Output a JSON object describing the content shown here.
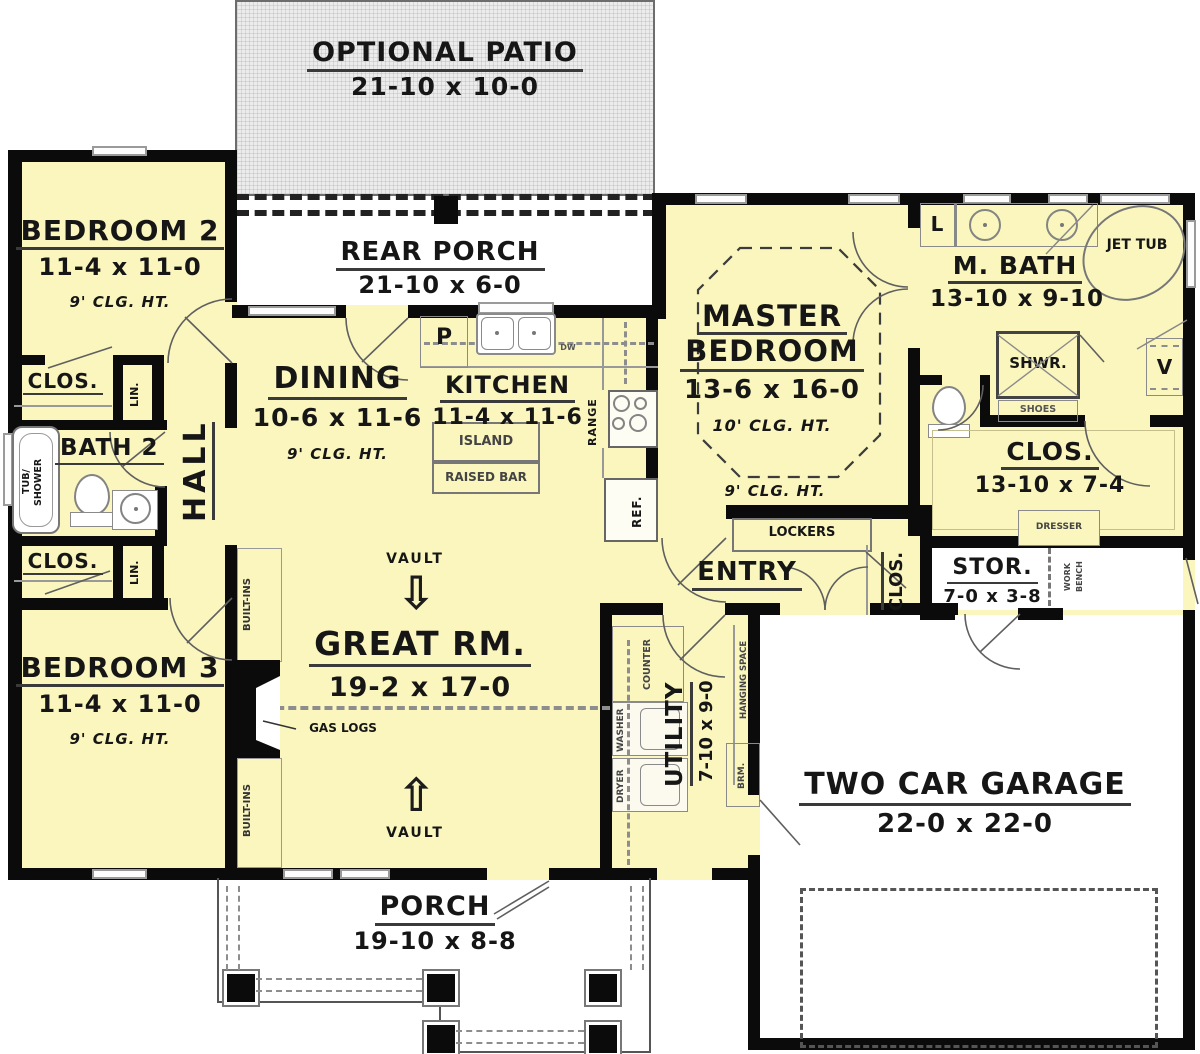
{
  "colors": {
    "floor": "#FAF6BE",
    "wall": "#0B0B0B",
    "patio_fill": "#ECECEC",
    "fixture_line": "#8A8A8A",
    "underline": "#3A3A3A"
  },
  "rooms": {
    "optional_patio": {
      "name": "OPTIONAL PATIO",
      "dims": "21-10 x 10-0"
    },
    "rear_porch": {
      "name": "REAR PORCH",
      "dims": "21-10 x 6-0"
    },
    "bedroom2": {
      "name": "BEDROOM 2",
      "dims": "11-4 x 11-0",
      "ceiling": "9' CLG. HT."
    },
    "bedroom3": {
      "name": "BEDROOM 3",
      "dims": "11-4 x 11-0",
      "ceiling": "9' CLG. HT."
    },
    "bath2": {
      "name": "BATH 2"
    },
    "hall": {
      "name": "HALL"
    },
    "dining": {
      "name": "DINING",
      "dims": "10-6 x 11-6",
      "ceiling": "9' CLG. HT."
    },
    "kitchen": {
      "name": "KITCHEN",
      "dims": "11-4 x 11-6"
    },
    "great_room": {
      "name": "GREAT RM.",
      "dims": "19-2 x 17-0"
    },
    "master_bedroom": {
      "name_line1": "MASTER",
      "name_line2": "BEDROOM",
      "dims": "13-6 x 16-0",
      "ceiling": "10' CLG. HT.",
      "ceiling_outer": "9' CLG. HT."
    },
    "master_bath": {
      "name": "M. BATH",
      "dims": "13-10 x 9-10"
    },
    "master_closet": {
      "name": "CLOS.",
      "dims": "13-10 x 7-4"
    },
    "entry": {
      "name": "ENTRY"
    },
    "storage": {
      "name": "STOR.",
      "dims": "7-0 x 3-8"
    },
    "utility": {
      "name": "UTILITY",
      "dims": "7-10 x 9-0"
    },
    "garage": {
      "name": "TWO CAR GARAGE",
      "dims": "22-0 x 22-0"
    },
    "porch": {
      "name": "PORCH",
      "dims": "19-10 x 8-8"
    }
  },
  "fixtures": {
    "closet": "CLOS.",
    "linen": "LIN.",
    "tub_line1": "TUB/",
    "tub_line2": "SHOWER",
    "pantry": "P",
    "dishwasher": "DW",
    "island": "ISLAND",
    "raised_bar": "RAISED BAR",
    "range": "RANGE",
    "refrigerator": "REF.",
    "lockers": "LOCKERS",
    "linen_cabinet": "L",
    "jet_tub": "JET TUB",
    "shower": "SHWR.",
    "shoes": "SHOES",
    "vanity": "V",
    "dresser": "DRESSER",
    "work_bench": "WORK BENCH",
    "vault": "VAULT",
    "gas_logs": "GAS LOGS",
    "built_ins": "BUILT-INS",
    "counter": "COUNTER",
    "washer": "WASHER",
    "dryer": "DRYER",
    "hanging_space": "HANGING SPACE",
    "broom": "BRM."
  },
  "icons": {
    "vault_arrow_down": "⇩",
    "vault_arrow_up": "⇧"
  }
}
